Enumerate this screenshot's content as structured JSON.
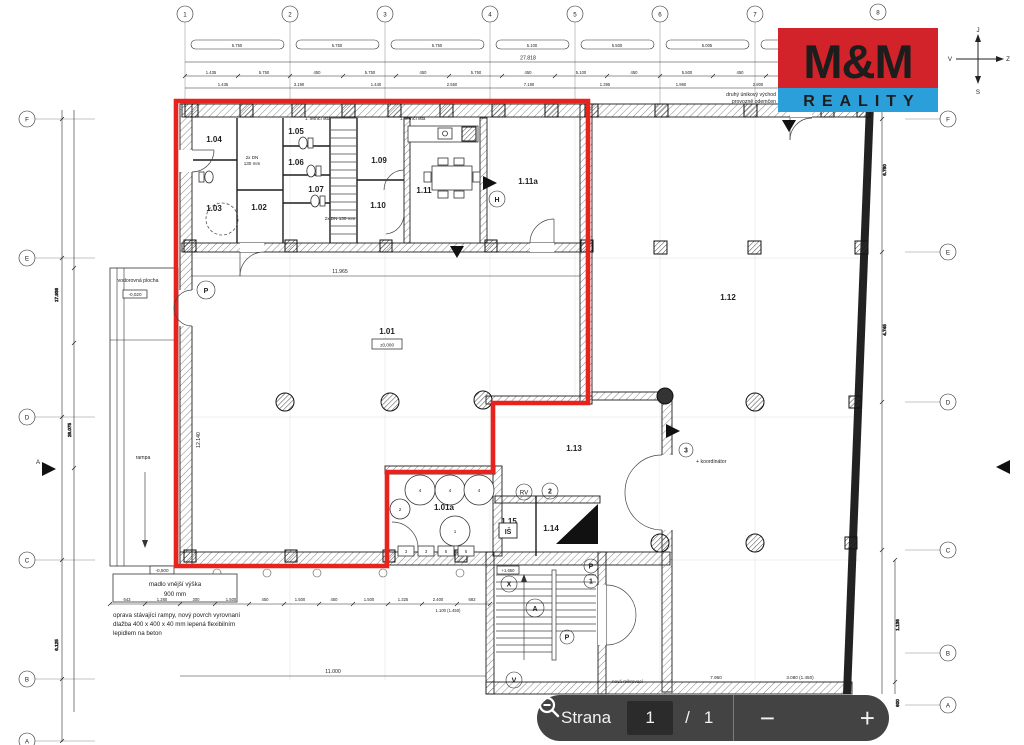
{
  "logo": {
    "top": "M&M",
    "bottom": "REALITY",
    "red": "#d2232a",
    "blue": "#2b9fd9"
  },
  "compass": {
    "top": "J",
    "right": "Z",
    "bottom": "S",
    "left": "V"
  },
  "toolbar": {
    "label": "Strana",
    "page": "1",
    "separator": "/",
    "total": "1",
    "zoom_out": "−",
    "zoom_in": "+"
  },
  "grid": {
    "cols": [
      "1",
      "2",
      "3",
      "4",
      "5",
      "6",
      "7",
      "8"
    ],
    "rows_left": [
      "F",
      "E",
      "D",
      "C",
      "B",
      "A"
    ],
    "rows_right": [
      "F",
      "E",
      "D",
      "C",
      "B",
      "A"
    ],
    "section": "A"
  },
  "rooms": {
    "r101": "1.01",
    "r101a": "1.01a",
    "r102": "1.02",
    "r103": "1.03",
    "r104": "1.04",
    "r105": "1.05",
    "r106": "1.06",
    "r107": "1.07",
    "r109": "1.09",
    "r110": "1.10",
    "r111": "1.11",
    "r111a": "1.11a",
    "r112": "1.12",
    "r113": "1.13",
    "r114": "1.14",
    "r115": "1.15"
  },
  "levels": {
    "main": "±0,000",
    "plateau": "-0,020",
    "dock": "-0,500",
    "stair": "+1.650"
  },
  "markers": {
    "p": "P",
    "h": "H",
    "rv": "RV",
    "n2": "2",
    "n3": "3",
    "n1": "1",
    "a": "A",
    "v": "V",
    "x": "X",
    "is": "IŠ"
  },
  "equipment": {
    "circles": [
      "4",
      "4",
      "4",
      "2",
      "1"
    ],
    "squares": [
      "3",
      "3",
      "5",
      "5"
    ]
  },
  "annotations": {
    "unik1": "druhý únikový východ",
    "unik2": "provozně odemčen",
    "lista": "1. těsnicí lišta",
    "dn_a1": "2x DN",
    "dn_a2": "130 mm",
    "dn_b": "2x DN 130 mm",
    "vodorovna": "vodorovná plocha",
    "rampa": "rampa",
    "koordinator": "+ koordinátor",
    "madlo1": "madlo vnější výška",
    "madlo2": "900 mm",
    "oprava1": "oprava stávající rampy, nový povrch vyrovnaní",
    "oprava2": "dlažba 400 x 400 x 40 mm lepená flexibilním",
    "oprava3": "lepidlem na beton",
    "nova": "nová mikrovací"
  },
  "dims": {
    "top_total": "27.818",
    "pills": [
      "5.750",
      "5.750",
      "5.750",
      "5.100",
      "5.500",
      "5.005",
      "5.140"
    ],
    "chain": [
      "1.435",
      "5.750",
      "450",
      "5.750",
      "450",
      "5.750",
      "450",
      "5.100",
      "450",
      "5.500",
      "450",
      "5.005",
      "450"
    ],
    "chain2": [
      "1.435",
      "3.190",
      "1.440",
      "2.550",
      "7.190",
      "1.395",
      "1.960",
      "2.800",
      "17.617"
    ],
    "left": [
      "17.936",
      "26.075",
      "6.125"
    ],
    "right": [
      "6.780",
      "4.745",
      "1.136",
      "600"
    ],
    "hall_w": "11.965",
    "hall_h": "12.140",
    "bottom": [
      "643",
      "1.280",
      "300",
      "1.500",
      "450",
      "1.500",
      "450",
      "1.500",
      "1.325",
      "2.400",
      "683"
    ],
    "bottom_note": "1.100 (1.450)",
    "bottom_total": "11.000",
    "br1": "7.960",
    "br2": "3.080 (1.450)"
  }
}
